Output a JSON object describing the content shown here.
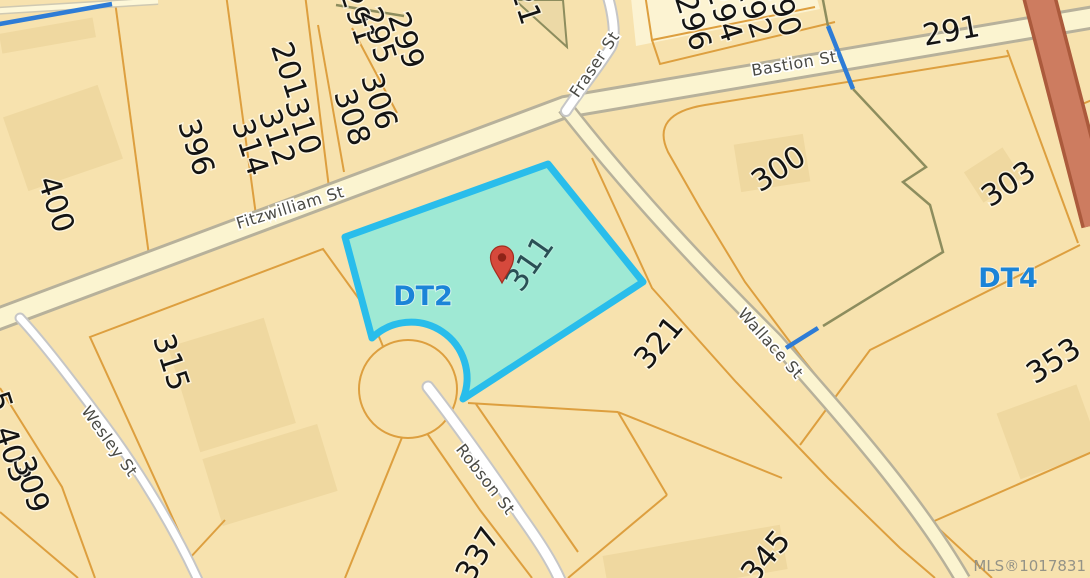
{
  "map": {
    "title": "parcel-map",
    "watermark": "MLS®1017831",
    "selected_parcel": "311",
    "streets": {
      "fitzwilliam": "Fitzwilliam St",
      "bastion": "Bastion St",
      "fraser": "Fraser St",
      "wallace": "Wallace St",
      "wesley": "Wesley St",
      "robson": "Robson St"
    },
    "zones": {
      "dt2": "DT2",
      "dt4": "DT4"
    },
    "parcels": {
      "p400": "400",
      "p396": "396",
      "p201": "201",
      "p314": "314",
      "p312": "312",
      "p310": "310",
      "p308": "308",
      "p306": "306",
      "p291": "291",
      "p295": "295",
      "p299": "299",
      "p296": "296",
      "p294": "294",
      "p292": "292",
      "p290": "290",
      "p291e": "291",
      "p300": "300",
      "p303": "303",
      "p353": "353",
      "p315": "315",
      "p321": "321",
      "p337": "337",
      "p345": "345",
      "p403": "403",
      "p309": "309",
      "p311": "311",
      "frag21": "21",
      "frag5": "5"
    },
    "colors": {
      "parcel_fill": "#f7e2ae",
      "building_fill": "#efd8a0",
      "lot_line_orange": "#dd9f3f",
      "highlight_fill": "#9fe9d4",
      "highlight_border": "#29bdeb",
      "road_major_fill": "#fbf4d0",
      "road_major_casing": "#b7b19b",
      "road_minor_fill": "#ffffff",
      "road_minor_casing": "#c6c6c6",
      "creek_blue": "#2e7cd6",
      "creek_olive": "#8d8d5e",
      "highway_fill": "#cd7c60",
      "highway_casing": "#ab5a3c",
      "zone_blue": "#1b84d8",
      "pin_red": "#d6493c"
    }
  }
}
